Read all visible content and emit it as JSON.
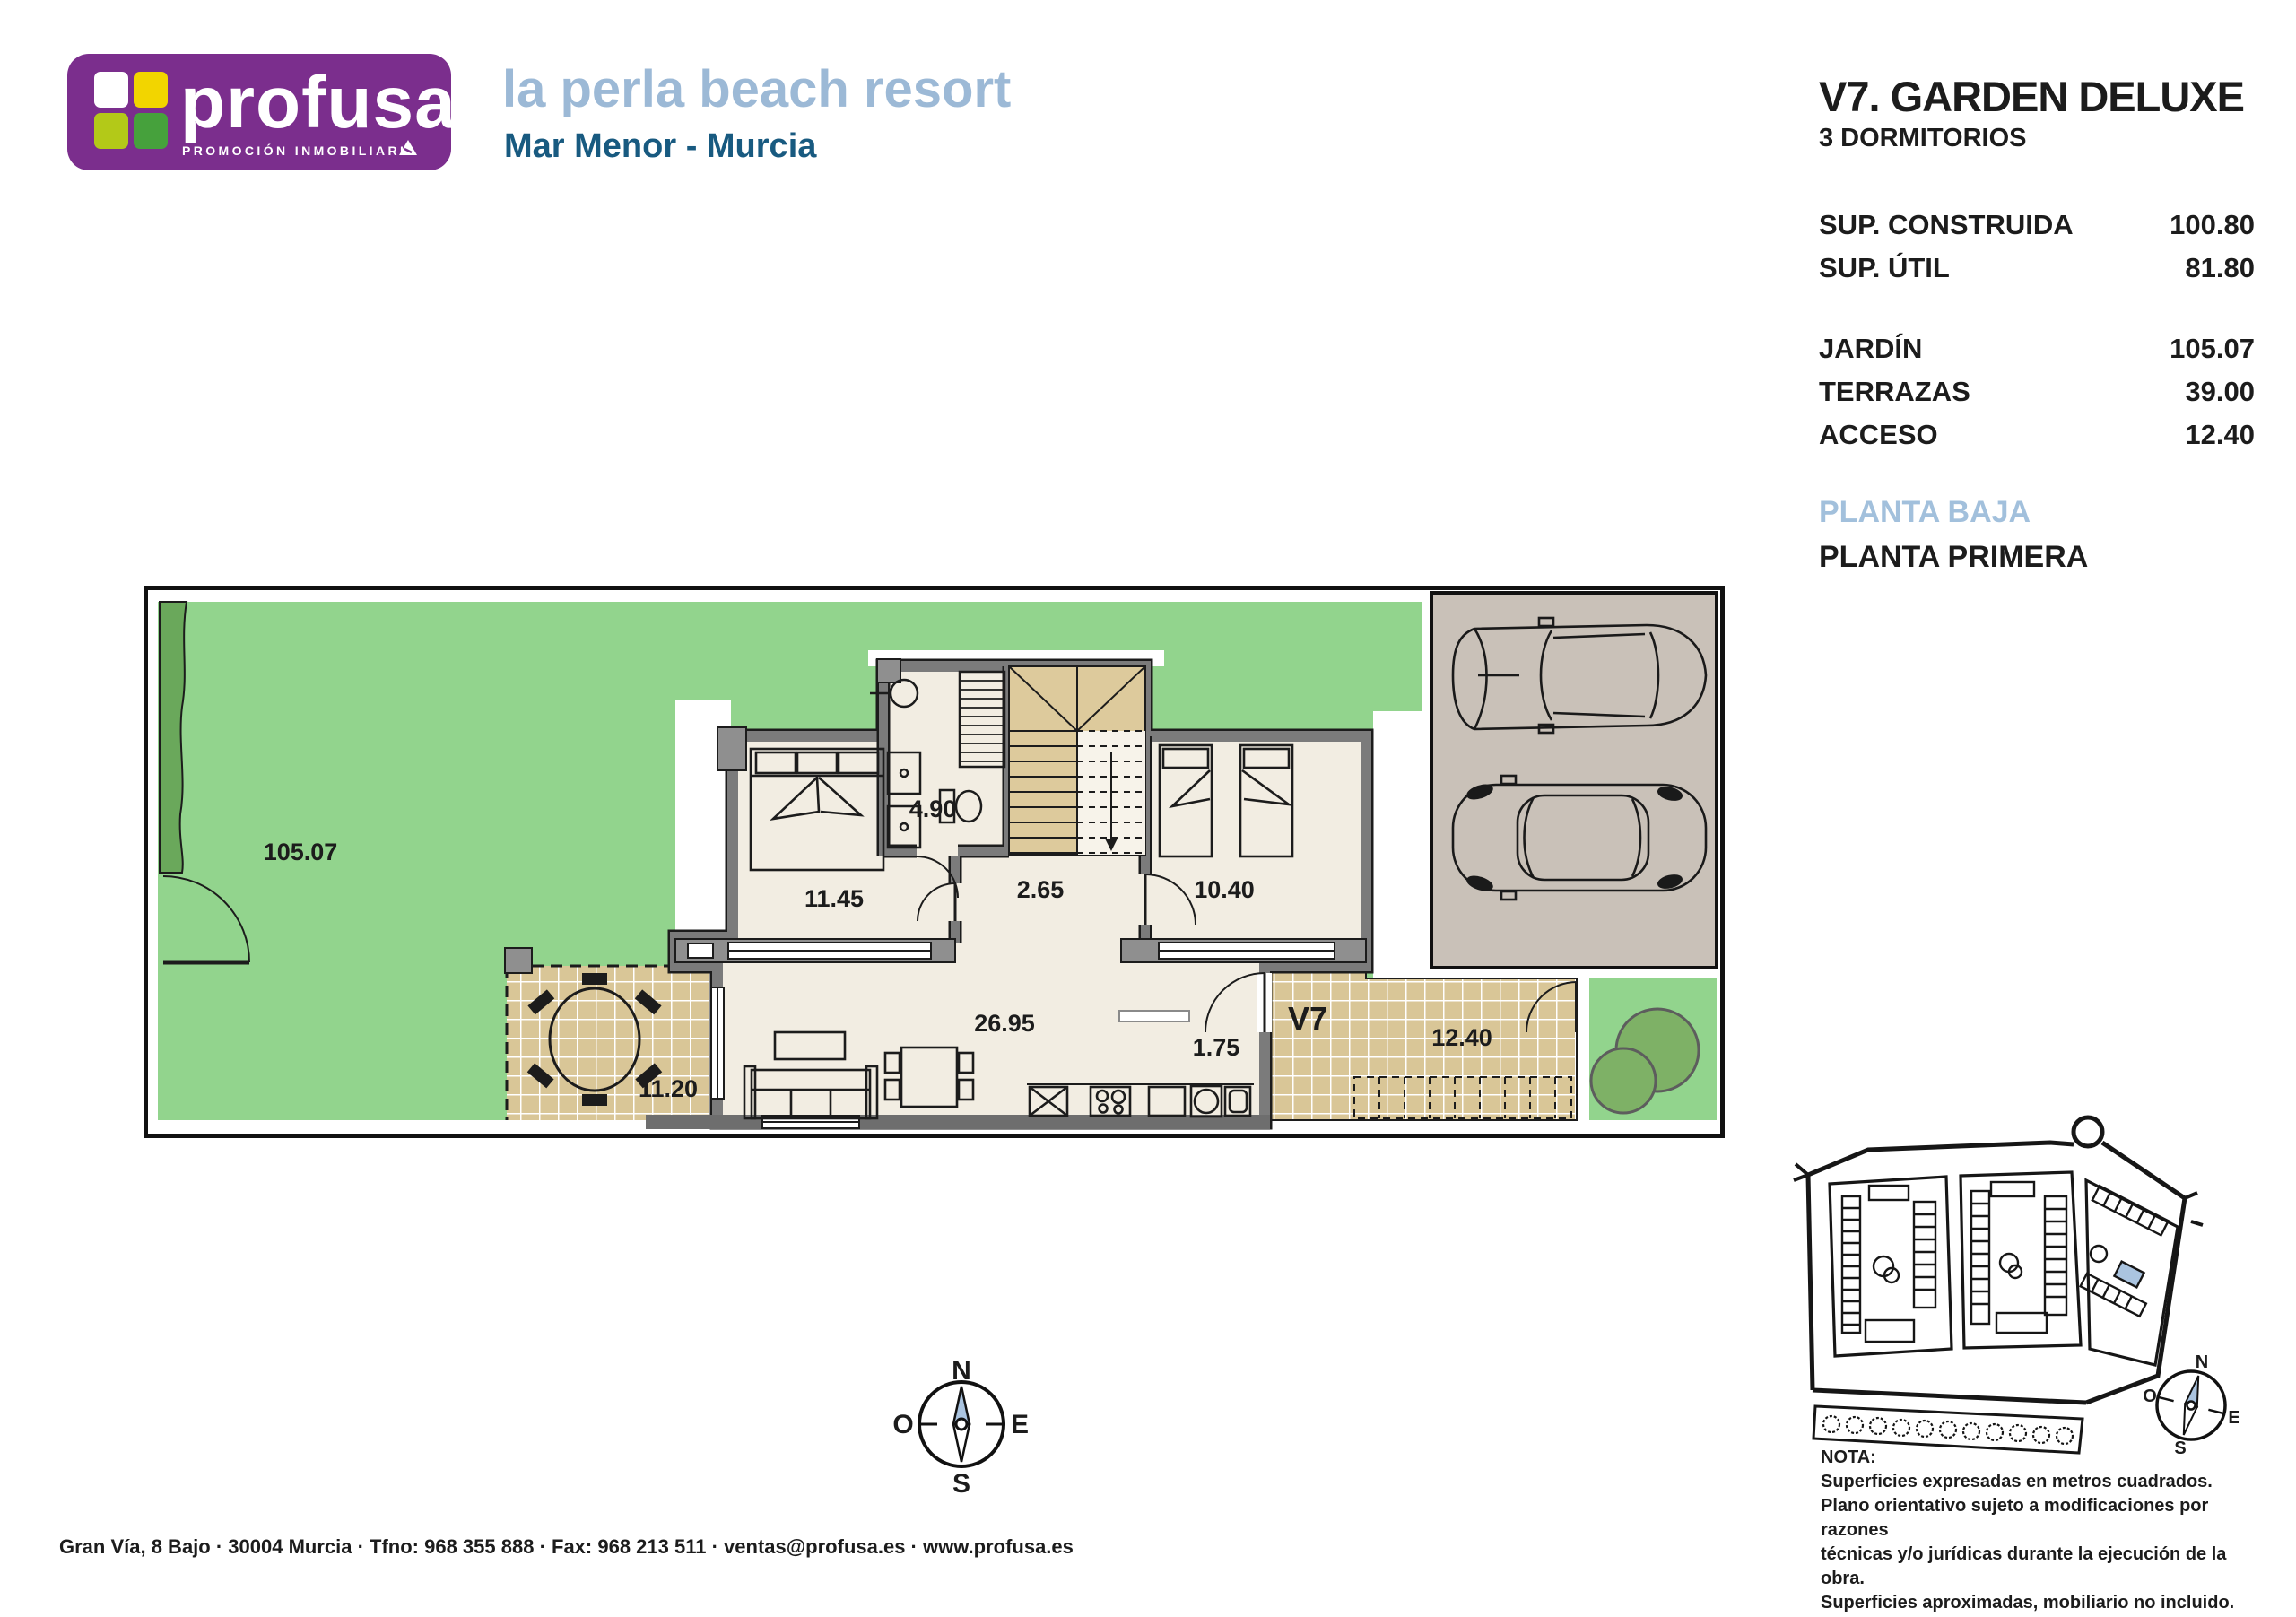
{
  "header": {
    "brand": "profusa",
    "tagline": "PROMOCIÓN INMOBILIARIA",
    "title": "la perla beach resort",
    "subtitle": "Mar Menor - Murcia"
  },
  "info_panel": {
    "unit_title": "V7. GARDEN DELUXE",
    "unit_subtitle": "3 DORMITORIOS",
    "areas_primary": [
      {
        "label": "SUP. CONSTRUIDA",
        "value": "100.80"
      },
      {
        "label": "SUP. ÚTIL",
        "value": "81.80"
      }
    ],
    "areas_secondary": [
      {
        "label": "JARDÍN",
        "value": "105.07"
      },
      {
        "label": "TERRAZAS",
        "value": "39.00"
      },
      {
        "label": "ACCESO",
        "value": "12.40"
      }
    ],
    "floor_current": "PLANTA BAJA",
    "floor_next": "PLANTA PRIMERA"
  },
  "floorplan": {
    "rooms": {
      "garden": "105.07",
      "bedroom_main": "11.45",
      "bathroom": "4.90",
      "hall": "2.65",
      "bedroom_second": "10.40",
      "living": "26.95",
      "laundry": "1.75",
      "terrace": "11.20",
      "unit_tag": "V7",
      "access": "12.40"
    },
    "compass": {
      "north": "N",
      "south": "S",
      "east": "E",
      "west": "O"
    }
  },
  "sitemap_compass": {
    "north": "N",
    "south": "S",
    "east": "E",
    "west": "O"
  },
  "note": {
    "title": "NOTA:",
    "lines": [
      "Superficies expresadas en metros cuadrados.",
      "Plano orientativo sujeto a modificaciones por razones",
      "técnicas y/o jurídicas durante la ejecución de la obra.",
      "Superficies aproximadas, mobiliario no incluido."
    ]
  },
  "footer": {
    "address": "Gran Vía, 8  Bajo · 30004 Murcia · Tfno: 968 355 888 · Fax: 968 213 511 · ventas@profusa.es · www.profusa.es"
  },
  "colors": {
    "brand_purple": "#7b2e8d",
    "title_blue": "#9cb9d6",
    "subtitle_blue": "#185a80",
    "plan_green": "#92d48d",
    "hedge_green": "#6aa85b",
    "tile_tan": "#d9c697",
    "stair_tan": "#ddca9c",
    "wall_gray": "#7b7b7b",
    "parking_taupe": "#c9c1b8",
    "compass_blue": "#aac4e0",
    "interior_cream": "#f2ede2"
  }
}
